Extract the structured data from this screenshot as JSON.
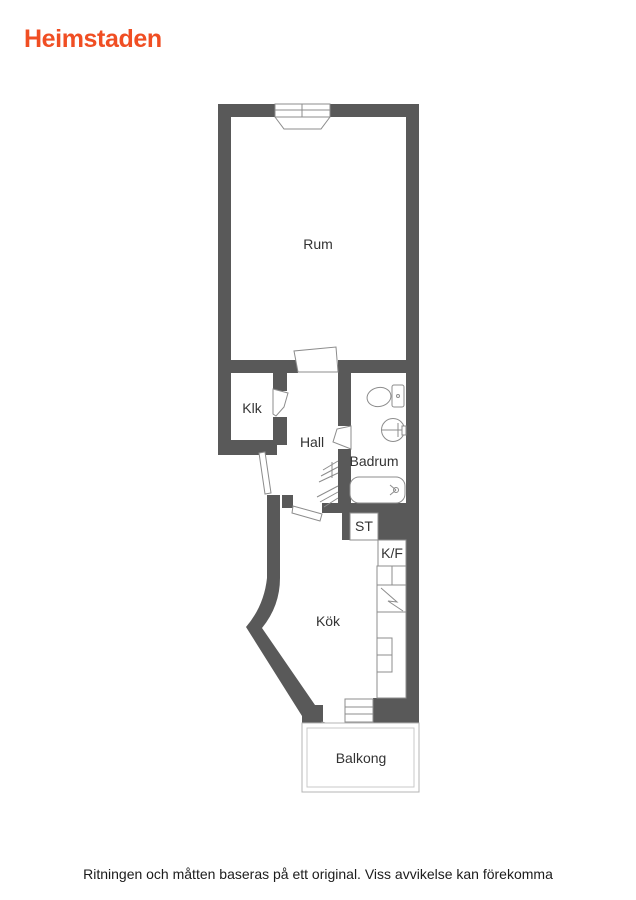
{
  "logo": {
    "text": "Heimstaden",
    "color": "#f04e23"
  },
  "disclaimer": "Ritningen och måtten baseras på ett original. Viss avvikelse kan förekomma",
  "plan": {
    "wall_color": "#595959",
    "fixture_line_color": "#8c8c8c",
    "label_color": "#333333",
    "rooms": [
      {
        "id": "rum",
        "label": "Rum"
      },
      {
        "id": "klk",
        "label": "Klk"
      },
      {
        "id": "hall",
        "label": "Hall"
      },
      {
        "id": "badrum",
        "label": "Badrum"
      },
      {
        "id": "st",
        "label": "ST"
      },
      {
        "id": "kf",
        "label": "K/F"
      },
      {
        "id": "kok",
        "label": "Kök"
      },
      {
        "id": "balkong",
        "label": "Balkong"
      }
    ],
    "fixtures": [
      "window",
      "toilet",
      "sink",
      "bathtub",
      "wardrobe-hatch",
      "stove",
      "kitchen-counter",
      "fridge-freezer-cabinet",
      "balcony-door",
      "balcony-window",
      "balcony-outline",
      "door-swings"
    ]
  }
}
